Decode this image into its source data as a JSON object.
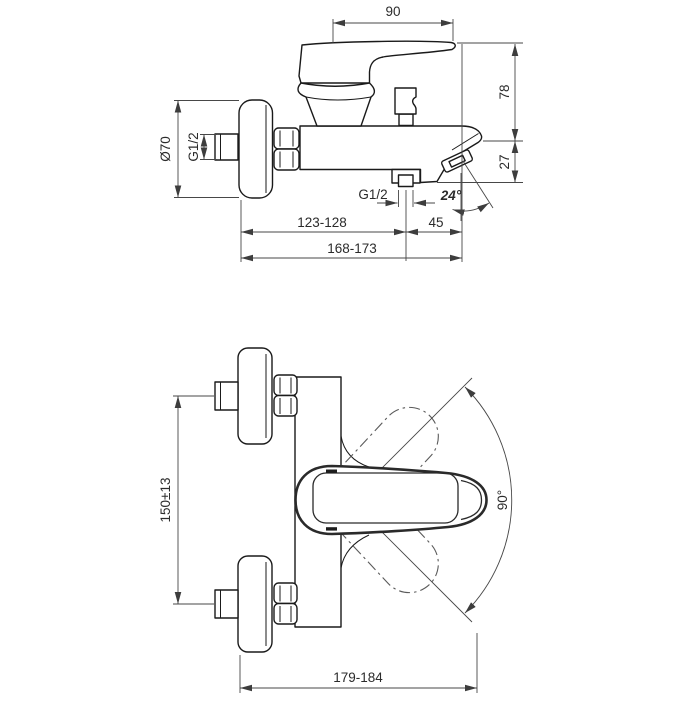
{
  "side_view": {
    "handle_length": "90",
    "height_above_axis": "78",
    "spout_drop": "27",
    "escutcheon_diameter": "Ø70",
    "inlet_thread": "G1/2",
    "shower_outlet_thread": "G1/2",
    "aerator_angle": "24°",
    "wall_to_shower_outlet": "123-128",
    "shower_outlet_to_front": "45",
    "total_projection": "168-173"
  },
  "top_view": {
    "inlet_spacing": "150±13",
    "handle_swivel": "90°",
    "overall_depth": "179-184"
  }
}
